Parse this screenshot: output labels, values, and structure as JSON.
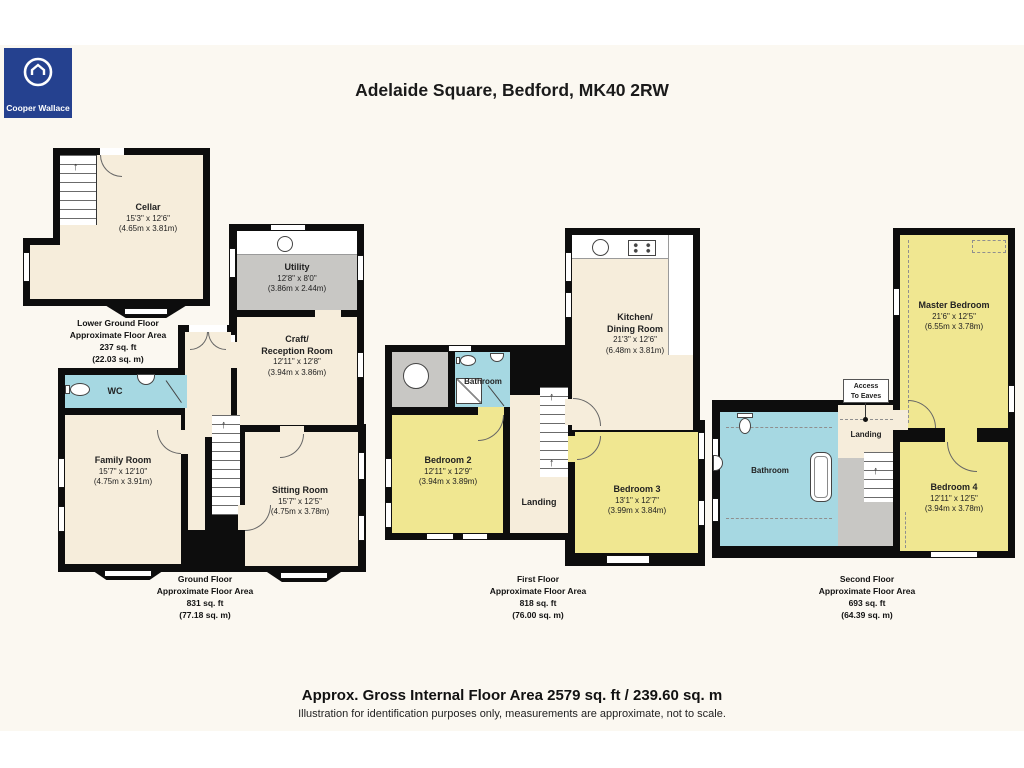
{
  "header": {
    "title": "Adelaide Square, Bedford, MK40 2RW"
  },
  "logo": {
    "name": "Cooper Wallace",
    "icon": "house-in-ring-icon",
    "bg_color": "#25418F",
    "text_color": "#FFFFFF"
  },
  "footer": {
    "line1": "Approx. Gross Internal Floor Area 2579 sq. ft / 239.60 sq. m",
    "line2": "Illustration for identification purposes only, measurements are approximate, not to scale."
  },
  "colors": {
    "canvas_cream": "#FBF8F1",
    "room_cream": "#F6EDDB",
    "room_yellow": "#F0E791",
    "room_blue": "#A6D8E2",
    "room_gray": "#C8C7C4",
    "wall_black": "#0D0D0D"
  },
  "icons": [
    "kitchen-sink-icon",
    "hob-icon",
    "toilet-icon",
    "hand-basin-icon",
    "shower-icon",
    "bathtub-icon",
    "water-tank-icon",
    "stairs-icon",
    "stairs-arrow-icon",
    "window-icon",
    "door-arc-icon"
  ],
  "floors": [
    {
      "id": "lower-ground-floor",
      "label": [
        "Lower Ground Floor",
        "Approximate Floor Area",
        "237 sq. ft",
        "(22.03 sq. m)"
      ],
      "rooms": {
        "cellar": {
          "name": "Cellar",
          "dims": "15'3\" x 12'6\"",
          "metric": "(4.65m x 3.81m)"
        }
      }
    },
    {
      "id": "ground-floor",
      "label": [
        "Ground Floor",
        "Approximate Floor Area",
        "831 sq. ft",
        "(77.18 sq. m)"
      ],
      "rooms": {
        "utility": {
          "name": "Utility",
          "dims": "12'8\" x 8'0\"",
          "metric": "(3.86m x 2.44m)"
        },
        "craft": {
          "name": "Craft/",
          "name2": "Reception Room",
          "dims": "12'11\" x 12'8\"",
          "metric": "(3.94m x 3.86m)"
        },
        "wc": {
          "name": "WC"
        },
        "family": {
          "name": "Family Room",
          "dims": "15'7\" x 12'10\"",
          "metric": "(4.75m x 3.91m)"
        },
        "sitting": {
          "name": "Sitting Room",
          "dims": "15'7\" x 12'5\"",
          "metric": "(4.75m x 3.78m)"
        }
      }
    },
    {
      "id": "first-floor",
      "label": [
        "First Floor",
        "Approximate Floor Area",
        "818 sq. ft",
        "(76.00 sq. m)"
      ],
      "rooms": {
        "kitchen": {
          "name": "Kitchen/",
          "name2": "Dining Room",
          "dims": "21'3\" x 12'6\"",
          "metric": "(6.48m x 3.81m)"
        },
        "bathroom": {
          "name": "Bathroom"
        },
        "bedroom2": {
          "name": "Bedroom 2",
          "dims": "12'11\" x 12'9\"",
          "metric": "(3.94m x 3.89m)"
        },
        "landing": {
          "name": "Landing"
        },
        "bedroom3": {
          "name": "Bedroom 3",
          "dims": "13'1\" x 12'7\"",
          "metric": "(3.99m x 3.84m)"
        }
      }
    },
    {
      "id": "second-floor",
      "label": [
        "Second Floor",
        "Approximate Floor Area",
        "693 sq. ft",
        "(64.39 sq. m)"
      ],
      "rooms": {
        "master": {
          "name": "Master Bedroom",
          "dims": "21'6\" x 12'5\"",
          "metric": "(6.55m x 3.78m)"
        },
        "bathroom": {
          "name": "Bathroom"
        },
        "landing": {
          "name": "Landing"
        },
        "access": {
          "line1": "Access",
          "line2": "To Eaves"
        },
        "bedroom4": {
          "name": "Bedroom 4",
          "dims": "12'11\" x 12'5\"",
          "metric": "(3.94m x 3.78m)"
        }
      }
    }
  ]
}
